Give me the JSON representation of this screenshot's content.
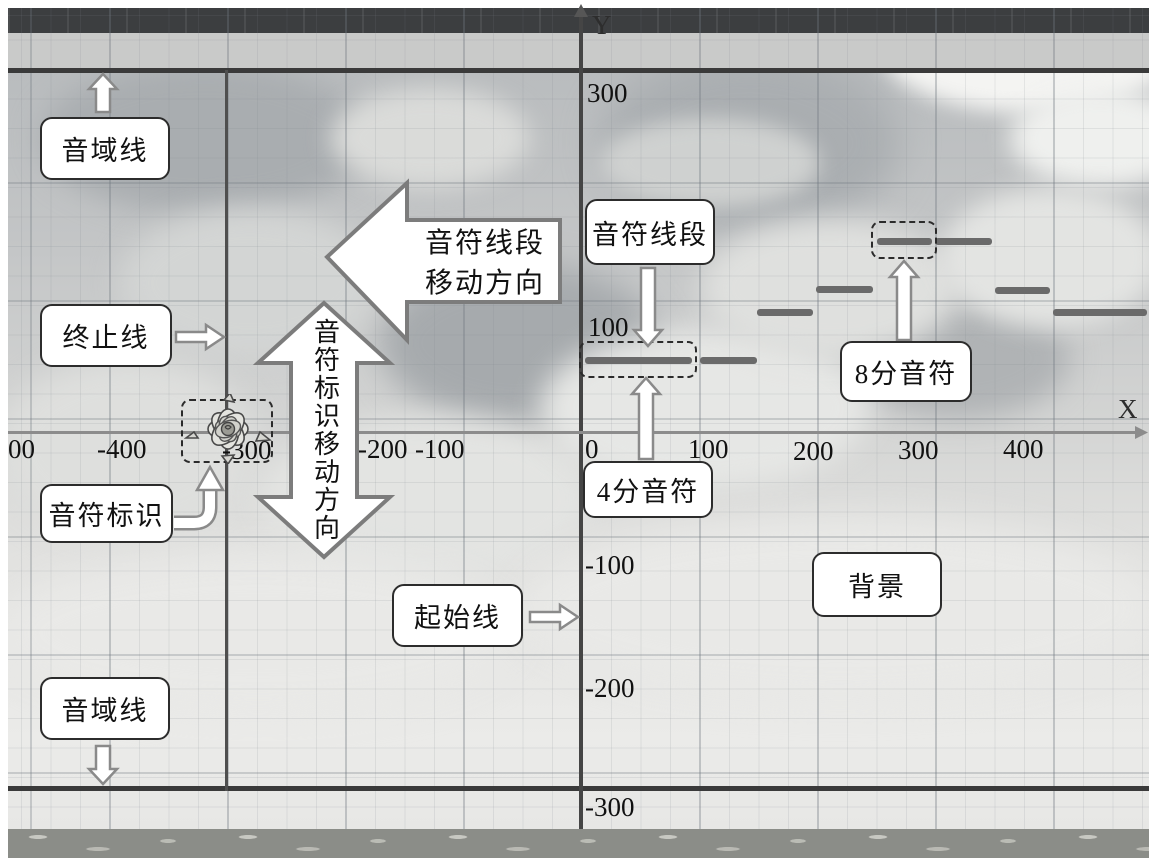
{
  "axes": {
    "x_label": "X",
    "y_label": "Y",
    "x_ticks": [
      "00",
      "-400",
      "-300",
      "-200",
      "-100",
      "0",
      "100",
      "200",
      "300",
      "400"
    ],
    "y_ticks": [
      "300",
      "100",
      "-100",
      "-200",
      "-300"
    ]
  },
  "callouts": {
    "range_line_top": "音域线",
    "end_line": "终止线",
    "note_marker": "音符标识",
    "range_line_bottom": "音域线",
    "start_line": "起始线",
    "quarter_note": "4分音符",
    "note_segment": "音符线段",
    "eighth_note": "8分音符",
    "background": "背景"
  },
  "direction_arrows": {
    "segment_move_line1": "音符线段",
    "segment_move_line2": "移动方向",
    "marker_move": "音符标识移动方向"
  },
  "notes": [
    {
      "x": 585,
      "y": 357,
      "w": 107
    },
    {
      "x": 700,
      "y": 357,
      "w": 57
    },
    {
      "x": 757,
      "y": 309,
      "w": 56
    },
    {
      "x": 816,
      "y": 286,
      "w": 57
    },
    {
      "x": 877,
      "y": 238,
      "w": 55
    },
    {
      "x": 935,
      "y": 238,
      "w": 57
    },
    {
      "x": 995,
      "y": 287,
      "w": 55
    },
    {
      "x": 1053,
      "y": 309,
      "w": 94
    }
  ],
  "colors": {
    "note": "#6a6a6a",
    "axis_dark": "#454545",
    "axis_light": "#8c8c8c",
    "range_line": "#3a3a3a",
    "callout_border": "#2c2c2c"
  }
}
